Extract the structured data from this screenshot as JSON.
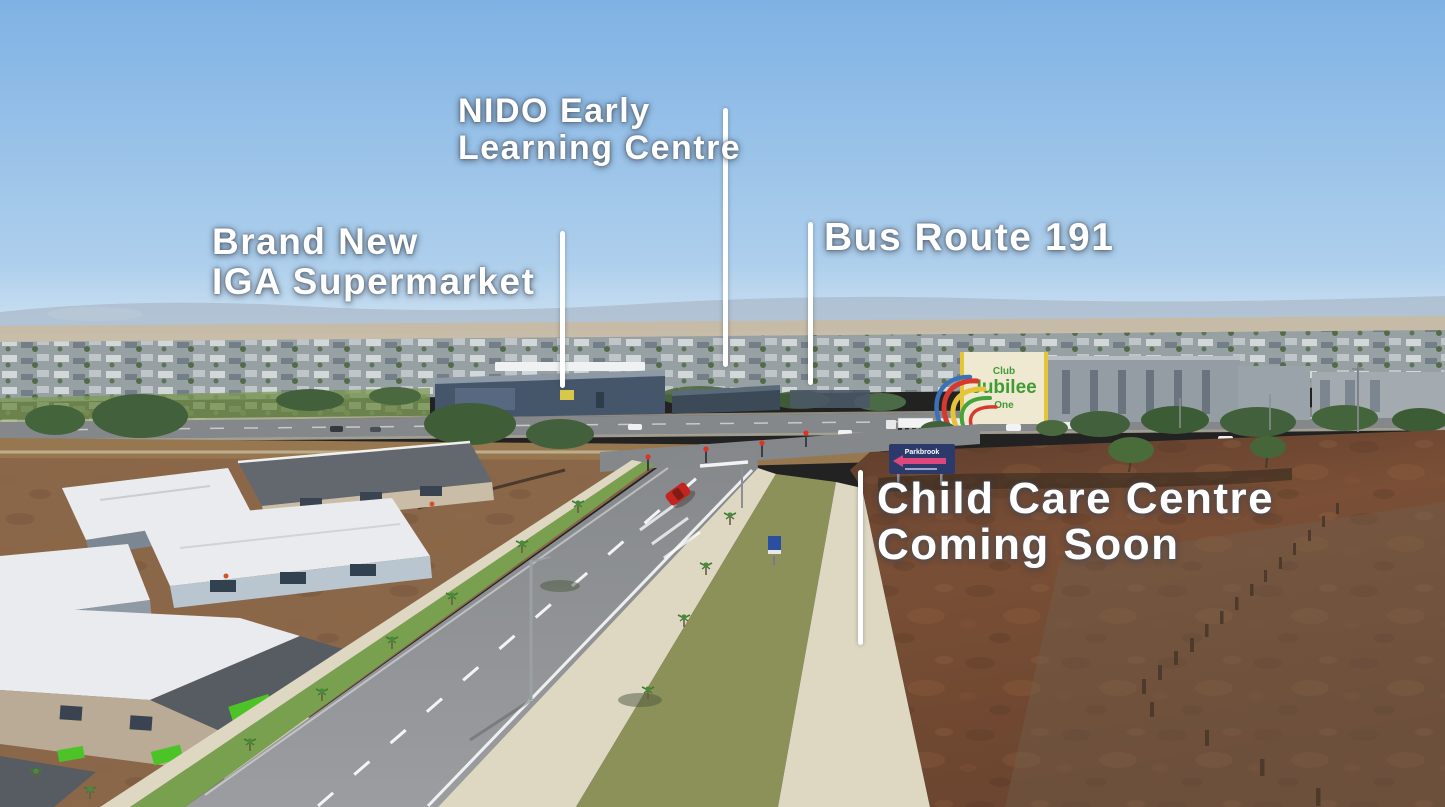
{
  "annotations": {
    "nido": {
      "line1": "NIDO Early",
      "line2": "Learning Centre"
    },
    "iga": {
      "line1": "Brand New",
      "line2": "IGA Supermarket"
    },
    "bus": {
      "label": "Bus Route 191"
    },
    "childcare": {
      "line1": "Child Care Centre",
      "line2": "Coming Soon"
    }
  },
  "scene": {
    "jubilee_sign": {
      "top": "Club",
      "main": "Jubilee",
      "sub": "One"
    },
    "billboard": {
      "title": "Parkbrook"
    }
  },
  "colors": {
    "sky_top": "#7fb2e4",
    "sky_horizon": "#d8e7f4",
    "hills": "#a9bac9",
    "farmland": "#c6bba4",
    "suburb_base": "#97a0a3",
    "tree_green": "#42603c",
    "reserve_green": "#7f9b59",
    "asphalt": "#85888b",
    "asphalt_fg": "#9b9da0",
    "concrete": "#ded7c2",
    "median_grass": "#8b9158",
    "nature_strip": "#78a04e",
    "dirt_red": "#7a4f36",
    "dirt_dark": "#5e3d2c",
    "dirt_left": "#8a6749",
    "turf": "#4cc427",
    "roof_white": "#e9ebee",
    "roof_dark": "#62686e",
    "building_slate": "#46566a",
    "jubilee_wall": "#efe9d2",
    "jubilee_text": "#3f9c35",
    "slide_red": "#d63a2e",
    "slide_yellow": "#e6c43a",
    "slide_green": "#46a33c",
    "slide_blue": "#3a72b8",
    "sign_navy": "#2c3a6b",
    "sign_pink": "#e0467e",
    "car_red": "#c42420"
  }
}
